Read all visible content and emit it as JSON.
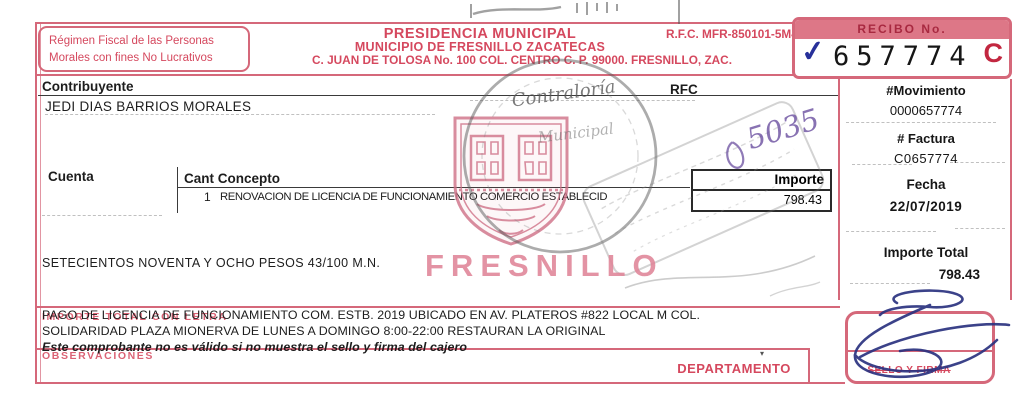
{
  "colors": {
    "form_red": "#d5485e",
    "border_pink": "#d5687a",
    "bar_pink": "#dd7787",
    "pen_blue": "#2b3280",
    "pen_purple": "#6b4fa0",
    "stamp_gray": "#6a6a6a",
    "ink_black": "#1d1d1d"
  },
  "icons": {
    "check": "✓",
    "down_arrow": "▾"
  },
  "header": {
    "fiscal_regime_line1": "Régimen Fiscal de las Personas",
    "fiscal_regime_line2": "Morales con fines No Lucrativos",
    "title1": "PRESIDENCIA MUNICIPAL",
    "title2": "MUNICIPIO DE FRESNILLO ZACATECAS",
    "address": "C. JUAN DE TOLOSA  No. 100   COL. CENTRO    C. P. 99000.   FRESNILLO, ZAC.",
    "rfc": "R.F.C. MFR-850101-5M4",
    "receipt_label": "RECIBO No.",
    "receipt_number": "657774",
    "receipt_series": "C"
  },
  "taxpayer": {
    "label": "Contribuyente",
    "name": "JEDI DIAS BARRIOS MORALES",
    "rfc_label": "RFC"
  },
  "right_column": {
    "movement_label": "#Movimiento",
    "movement": "0000657774",
    "invoice_label": "# Factura",
    "invoice": "C0657774",
    "date_label": "Fecha",
    "date": "22/07/2019",
    "total_label": "Importe Total",
    "total": "798.43"
  },
  "detail": {
    "account_label": "Cuenta",
    "qty_concept_label": "Cant Concepto",
    "line_qty": "1",
    "line_concept": "RENOVACION DE LICENCIA DE FUNCIONAMIENTO COMERCIO ESTABLECID",
    "amount_label": "Importe",
    "amount": "798.43",
    "amount_words": "SETECIENTOS NOVENTA Y OCHO PESOS 43/100 M.N."
  },
  "stamps": {
    "city_watermark": "FRESNILLO",
    "contraloria_line1": "Contraloría",
    "contraloria_line2": "Municipal",
    "handwritten_number": "5035"
  },
  "footer": {
    "form_label_words": "IMPORTE TOTAL CON LETRA",
    "line1": "PAGO DE LICENCIA DE FUNCIONAMIENTO COM. ESTB. 2019 UBICADO EN AV. PLATEROS #822 LOCAL M COL.",
    "line2": "SOLIDARIDAD PLAZA MIONERVA DE LUNES A DOMINGO 8:00-22:00 RESTAURAN LA ORIGINAL",
    "notice": "Este comprobante no es válido si no muestra el sello y firma del cajero",
    "observations_label": "OBSERVACIONES",
    "department_label": "DEPARTAMENTO",
    "seal_label": "SELLO Y FIRMA"
  }
}
